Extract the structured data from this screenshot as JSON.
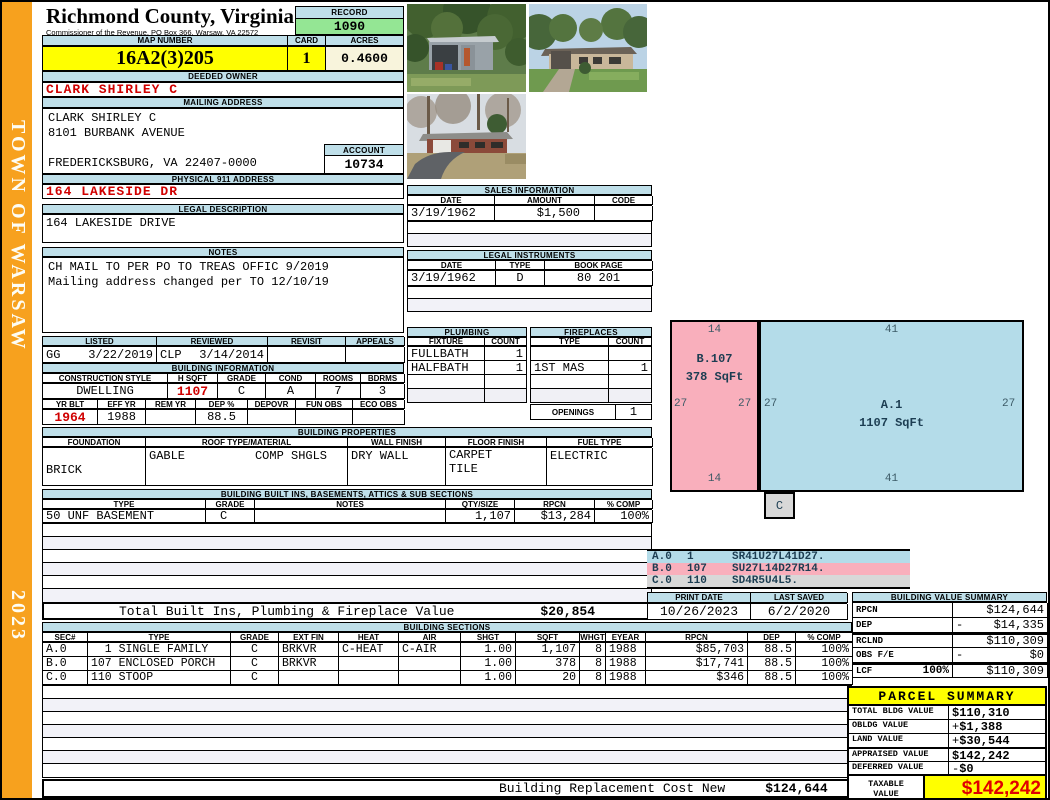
{
  "sidebar": {
    "town": "TOWN OF WARSAW",
    "year": "2023"
  },
  "header": {
    "county": "Richmond County, Virginia",
    "commissioner": "Commissioner of the Revenue, PO Box 366, Warsaw, VA 22572",
    "record_label": "RECORD",
    "record_value": "1090",
    "map_number_label": "MAP NUMBER",
    "map_number": "16A2(3)205",
    "card_label": "CARD",
    "card": "1",
    "acres_label": "ACRES",
    "acres": "0.4600"
  },
  "owner": {
    "deeded_owner_label": "DEEDED OWNER",
    "deeded_owner": "CLARK SHIRLEY C",
    "mailing_address_label": "MAILING ADDRESS",
    "mail_line1": "CLARK SHIRLEY C",
    "mail_line2": "8101 BURBANK AVENUE",
    "mail_line3": "FREDERICKSBURG, VA 22407-0000",
    "account_label": "ACCOUNT",
    "account": "10734",
    "physical_address_label": "PHYSICAL 911 ADDRESS",
    "physical_address": "164 LAKESIDE DR",
    "legal_description_label": "LEGAL DESCRIPTION",
    "legal_description": "164 LAKESIDE DRIVE",
    "notes_label": "NOTES",
    "note1": "CH MAIL TO PER PO TO TREAS OFFIC 9/2019",
    "note2": "Mailing address changed per TO 12/10/19"
  },
  "review": {
    "listed_label": "LISTED",
    "reviewed_label": "REVIEWED",
    "revisit_label": "REVISIT",
    "appeals_label": "APPEALS",
    "listed_code": "GG",
    "listed_date": "3/22/2019",
    "reviewed_code": "CLP",
    "reviewed_date": "3/14/2014",
    "revisit": "",
    "appeals": ""
  },
  "building_information": {
    "title": "BUILDING INFORMATION",
    "h1": [
      "CONSTRUCTION STYLE",
      "H SQFT",
      "GRADE",
      "COND",
      "ROOMS",
      "BDRMS"
    ],
    "v1": [
      "DWELLING",
      "1107",
      "C",
      "A",
      "7",
      "3"
    ],
    "h2": [
      "YR BLT",
      "EFF YR",
      "REM YR",
      "DEP %",
      "DEPOVR",
      "FUN OBS",
      "ECO OBS"
    ],
    "v2": [
      "1964",
      "1988",
      "",
      "88.5",
      "",
      "",
      ""
    ]
  },
  "building_properties": {
    "title": "BUILDING PROPERTIES",
    "headers": [
      "FOUNDATION",
      "ROOF TYPE/MATERIAL",
      "WALL FINISH",
      "FLOOR FINISH",
      "FUEL TYPE"
    ],
    "foundation": "BRICK",
    "roof_type": "GABLE",
    "roof_material": "COMP SHGLS",
    "wall_finish": "DRY WALL",
    "floor_finish1": "CARPET",
    "floor_finish2": "TILE",
    "fuel_type": "ELECTRIC"
  },
  "built_ins": {
    "title": "BUILDING BUILT INS, BASEMENTS, ATTICS & SUB SECTIONS",
    "headers": [
      "TYPE",
      "GRADE",
      "NOTES",
      "QTY/SIZE",
      "RPCN",
      "% COMP"
    ],
    "rows": [
      [
        "50 UNF BASEMENT",
        "C",
        "",
        "1,107",
        "$13,284",
        "100%"
      ]
    ],
    "total_label": "Total Built Ins, Plumbing & Fireplace Value",
    "total_value": "$20,854"
  },
  "sales": {
    "title": "SALES INFORMATION",
    "headers": [
      "DATE",
      "AMOUNT",
      "CODE"
    ],
    "rows": [
      [
        "3/19/1962",
        "$1,500",
        ""
      ]
    ]
  },
  "instruments": {
    "title": "LEGAL INSTRUMENTS",
    "headers": [
      "DATE",
      "TYPE",
      "BOOK PAGE"
    ],
    "rows": [
      [
        "3/19/1962",
        "D",
        "80 201"
      ]
    ]
  },
  "plumbing": {
    "title": "PLUMBING",
    "headers": [
      "FIXTURE",
      "COUNT"
    ],
    "rows": [
      [
        "FULLBATH",
        "1"
      ],
      [
        "HALFBATH",
        "1"
      ]
    ]
  },
  "fireplaces": {
    "title": "FIREPLACES",
    "headers": [
      "TYPE",
      "COUNT"
    ],
    "rows": [
      [
        "",
        ""
      ],
      [
        "1ST MAS",
        "1"
      ]
    ],
    "openings_label": "OPENINGS",
    "openings": "1"
  },
  "sketch": {
    "b": {
      "label": "B.107",
      "sqft": "378 SqFt",
      "top": "14",
      "bottom": "14",
      "left": "27",
      "right": "27",
      "color": "#F9AFBC"
    },
    "a": {
      "label": "A.1",
      "sqft": "1107 SqFt",
      "top": "41",
      "bottom": "41",
      "left": "27",
      "right": "27",
      "color": "#B4DCE9"
    },
    "c_label": "C",
    "legend": [
      {
        "code": "A.0",
        "num": "1",
        "path": "SR41U27L41D27.",
        "color": "#B4DCE9"
      },
      {
        "code": "B.0",
        "num": "107",
        "path": "SU27L14D27R14.",
        "color": "#F9AFBC"
      },
      {
        "code": "C.0",
        "num": "110",
        "path": "SD4R5U4L5.",
        "color": "#D8D8D8"
      }
    ]
  },
  "dates": {
    "print_date_label": "PRINT DATE",
    "print_date": "10/26/2023",
    "last_saved_label": "LAST SAVED",
    "last_saved": "6/2/2020"
  },
  "building_value_summary": {
    "title": "BUILDING VALUE SUMMARY",
    "rows": [
      {
        "label": "RPCN",
        "pct": "",
        "op": "",
        "value": "$124,644"
      },
      {
        "label": "DEP",
        "pct": "",
        "op": "-",
        "value": "$14,335"
      },
      {
        "label": "RCLND",
        "pct": "",
        "op": "",
        "value": "$110,309"
      },
      {
        "label": "OBS F/E",
        "pct": "",
        "op": "-",
        "value": "$0"
      },
      {
        "label": "LCF",
        "pct": "100%",
        "op": "",
        "value": "$110,309"
      }
    ]
  },
  "building_sections": {
    "title": "BUILDING SECTIONS",
    "headers": [
      "SEC#",
      "TYPE",
      "GRADE",
      "EXT FIN",
      "HEAT",
      "AIR",
      "SHGT",
      "SQFT",
      "WHGT",
      "EYEAR",
      "RPCN",
      "DEP",
      "% COMP"
    ],
    "rows": [
      [
        "A.0",
        "  1 SINGLE FAMILY",
        "C",
        "BRKVR",
        "C-HEAT",
        "C-AIR",
        "1.00",
        "1,107",
        "8",
        "1988",
        "$85,703",
        "88.5",
        "100%"
      ],
      [
        "B.0",
        "107 ENCLOSED PORCH",
        "C",
        "BRKVR",
        "",
        "",
        "1.00",
        "378",
        "8",
        "1988",
        "$17,741",
        "88.5",
        "100%"
      ],
      [
        "C.0",
        "110 STOOP",
        "C",
        "",
        "",
        "",
        "1.00",
        "20",
        "8",
        "1988",
        "$346",
        "88.5",
        "100%"
      ]
    ],
    "footer_label": "Building Replacement Cost New",
    "footer_value": "$124,644"
  },
  "parcel_summary": {
    "title": "PARCEL SUMMARY",
    "rows": [
      {
        "label": "TOTAL BLDG VALUE",
        "op": "",
        "value": "$110,310"
      },
      {
        "label": "OBLDG VALUE",
        "op": "+",
        "value": "$1,388"
      },
      {
        "label": "LAND VALUE",
        "op": "+",
        "value": "$30,544"
      },
      {
        "label": "APPRAISED VALUE",
        "op": "",
        "value": "$142,242"
      },
      {
        "label": "DEFERRED VALUE",
        "op": "-",
        "value": "$0"
      }
    ],
    "taxable_label1": "TAXABLE",
    "taxable_label2": "VALUE",
    "taxable_value": "$142,242"
  },
  "photos": [
    "shed-photo",
    "house-front-photo",
    "house-driveway-photo"
  ],
  "colors": {
    "accent_blue": "#BFDFE9",
    "yellow": "#FFFF00",
    "green": "#94E694",
    "cream": "#F8F4DC",
    "orange": "#F7A11E",
    "red": "#D00000"
  }
}
